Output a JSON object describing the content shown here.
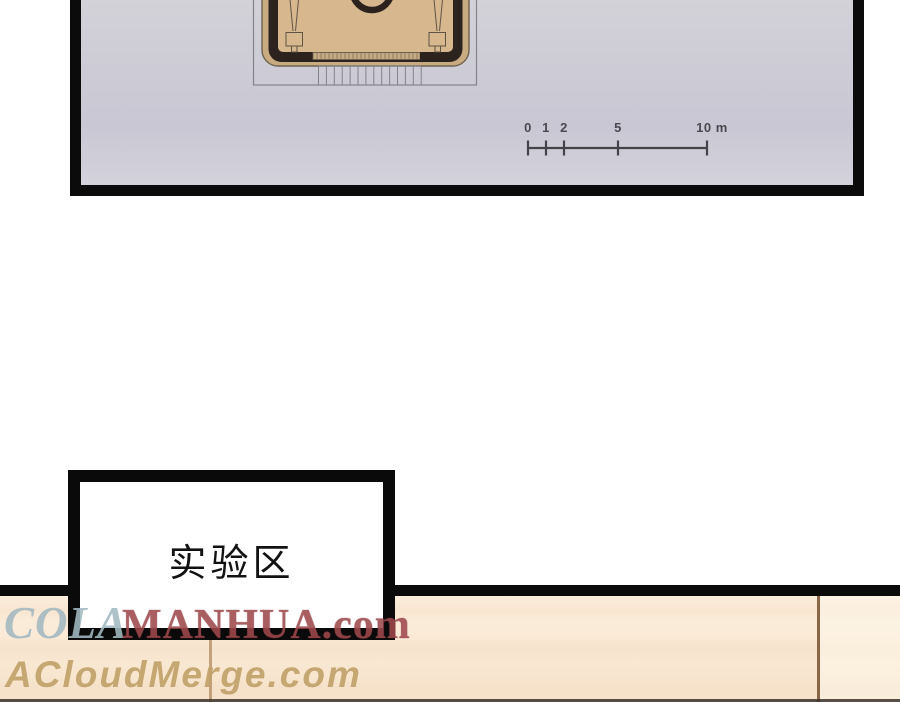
{
  "map_panel": {
    "description": "site plan of a building on lavender-gray ground, top edge cropped",
    "scale_bar": {
      "ticks": [
        {
          "label": "0",
          "meters": 0
        },
        {
          "label": "1",
          "meters": 1
        },
        {
          "label": "2",
          "meters": 2
        },
        {
          "label": "5",
          "meters": 5
        },
        {
          "label": "10 m",
          "meters": 10
        }
      ]
    }
  },
  "caption_box": {
    "text": "实验区"
  },
  "watermarks": {
    "primary_prefix": "COLA",
    "primary_suffix": "MANHUA.com",
    "secondary": "ACloudMerge.com"
  },
  "colors": {
    "panel_border": "#0b0b0b",
    "panel_bg_top": "#d5d4da",
    "panel_bg_bottom": "#d4d3dc",
    "plan_interior_tan": "#d6b78e",
    "plan_rim_tan": "#c9ab81",
    "plan_wall_dark": "#2c231f",
    "plan_outline_gray": "#85828a",
    "scale_bar_color": "#45434a",
    "floor_cream": "#fbeedd",
    "floor_board_line": "#8a6647",
    "watermark_cola": "#a2b9c1",
    "watermark_manhua_red": "#9e484d",
    "watermark_acm_tan": "#c1a26b"
  }
}
